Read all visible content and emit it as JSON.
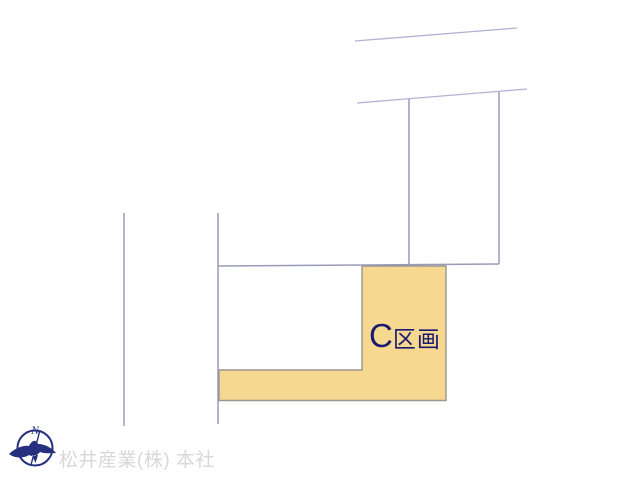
{
  "diagram": {
    "highlight": {
      "label_letter": "C",
      "label_word": "区画"
    },
    "compass": {
      "north_label": "N"
    },
    "watermark": "松井産業(株) 本社"
  },
  "colors": {
    "parcel_line": "#9a9ab8",
    "road_line": "#b2b2d4",
    "highlight_fill": "#f7d891",
    "highlight_border": "#9a958e",
    "section_label": "#1a1a70",
    "compass": "#27307e",
    "watermark": "#d8d8d8"
  }
}
